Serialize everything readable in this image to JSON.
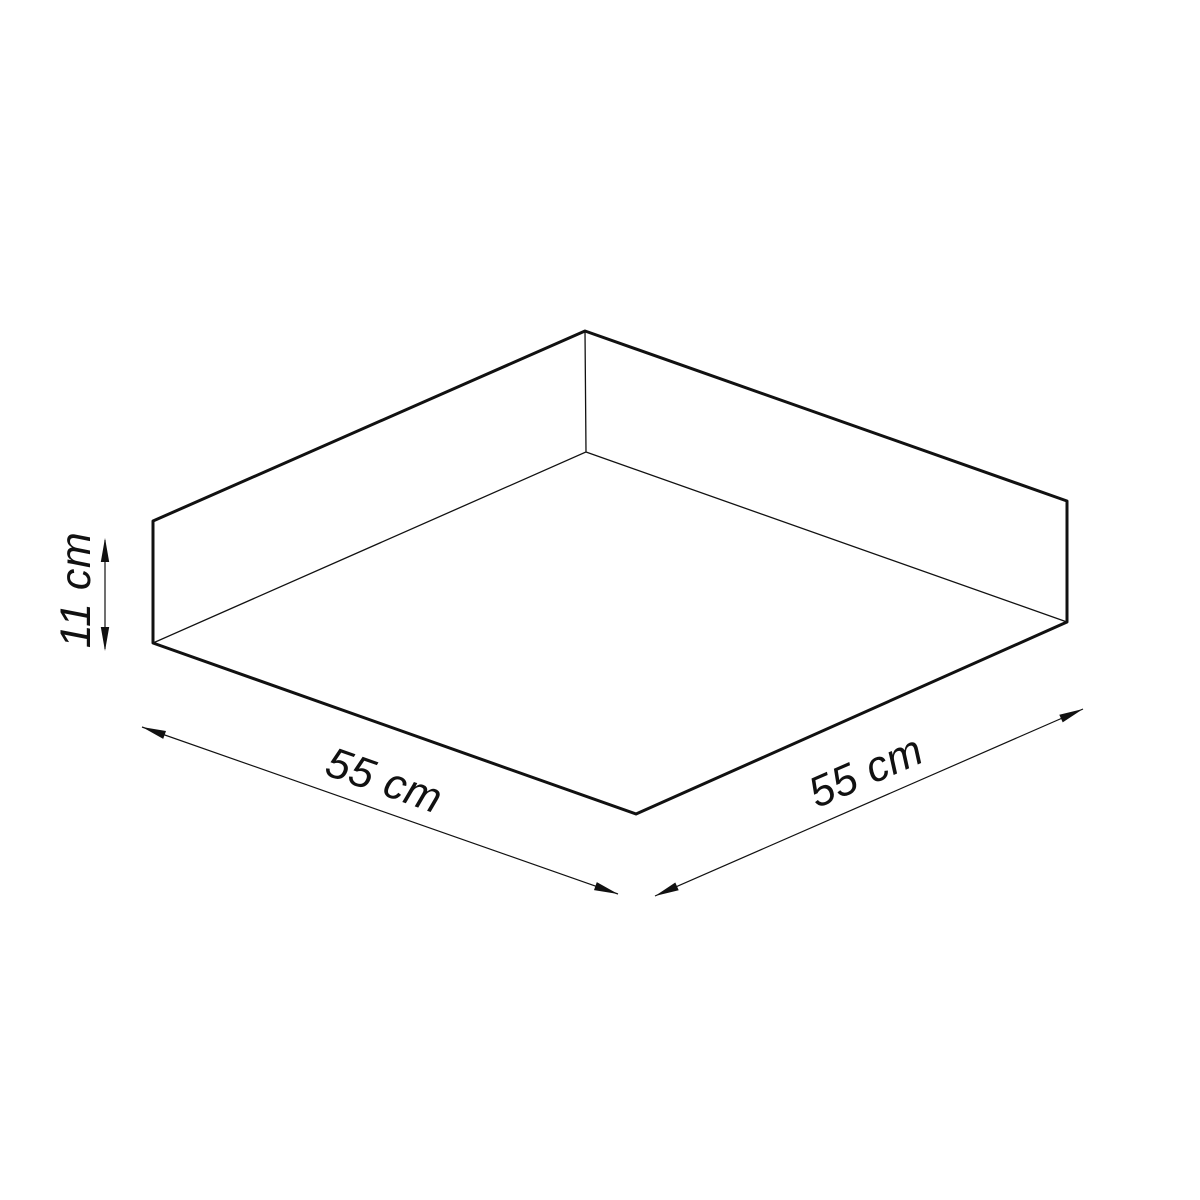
{
  "diagram": {
    "labels": {
      "height": "11 cm",
      "width": "55 cm",
      "depth": "55 cm"
    },
    "colors": {
      "background": "#ffffff",
      "line": "#111111"
    }
  }
}
